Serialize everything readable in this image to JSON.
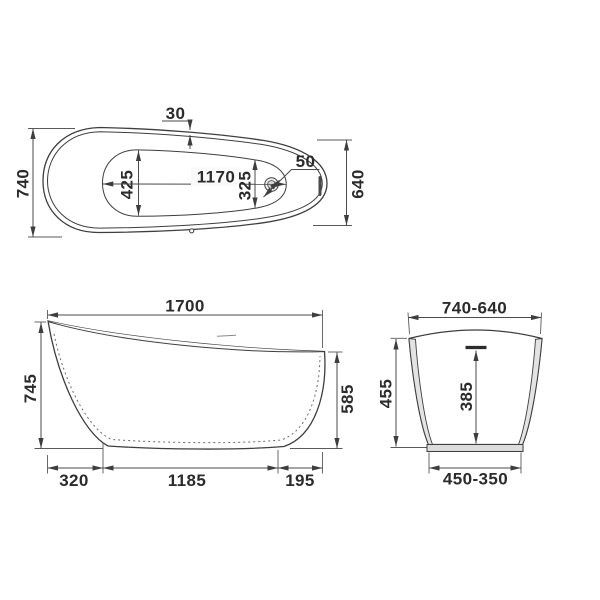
{
  "drawing": {
    "type": "bathtub-technical-drawing",
    "background": "#ffffff",
    "line_color": "#3e3e3e",
    "text_color": "#2b2b2b",
    "body_fill": "#e7e7e7",
    "top_view": {
      "rim_offset": "30",
      "overall_width": "740",
      "basin_width_back": "425",
      "basin_length": "1170",
      "basin_width_front": "325",
      "drain_diameter": "50",
      "overall_width_foot_end": "640"
    },
    "side_view": {
      "overall_length": "1700",
      "height_back": "745",
      "height_front": "585",
      "base_offset_back": "320",
      "base_length": "1185",
      "base_offset_front": "195"
    },
    "end_view": {
      "width_top": "740-640",
      "height": "455",
      "depth_inner": "385",
      "width_bottom": "450-350"
    }
  }
}
